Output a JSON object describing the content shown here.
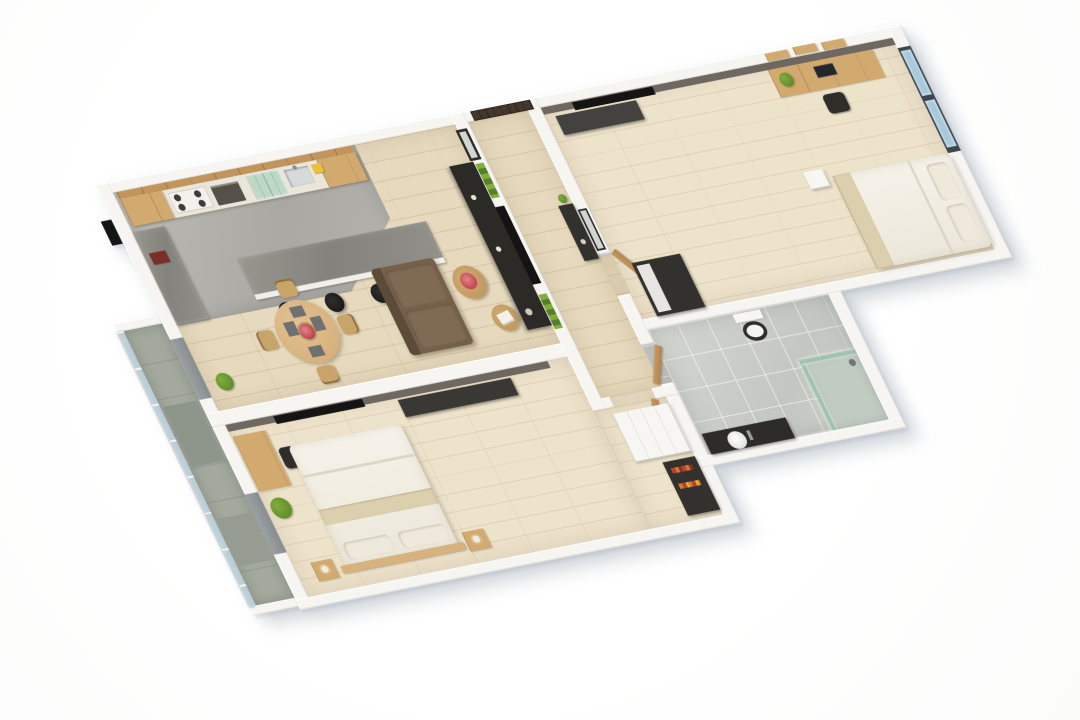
{
  "scene": {
    "type": "3d-floor-plan-render",
    "view": "isometric-birds-eye",
    "rotation_deg": -22,
    "background": "#ffffff",
    "visible_text": ""
  },
  "palette": {
    "wall": "#f6f5f2",
    "wall_edge": "#e2e0da",
    "wood_floor": "#e6d9bd",
    "wood_light": "#ede2ca",
    "concrete": "#aeada8",
    "tile": "#cdcfca",
    "balcony_floor": "#a3a99d",
    "stone_counter": "#8c8b85",
    "cabinet_wood": "#d2a96f",
    "counter_white": "#eae6dc",
    "entry_door": "#43372e",
    "door_wood": "#c79a62",
    "accent_wall": "#6f6861",
    "dark_unit": "#33312d",
    "media_dark": "#2b2a27",
    "sofa": "#75604b",
    "sofa_dark": "#5d4b39",
    "table_wood": "#d7b27e",
    "wicker": "#c09a62",
    "green": "#7fae3a",
    "green_dark": "#567f2a",
    "flower_red": "#c2464e",
    "glass_blue": "#a7c9db",
    "window_frame": "#3d474f",
    "glass_green": "#bcd9c8",
    "white_fixture": "#f7f6f2",
    "black": "#141414",
    "bed_white": "#f5f2ea",
    "pillow": "#efe9dc",
    "throw": "#dccfae",
    "gray_panel": "#8f9598"
  },
  "rooms": [
    {
      "id": "kitchen",
      "floor": "concrete-and-wood",
      "items": [
        "upper-cabinets-glass",
        "base-cabinet-run",
        "gas-stove",
        "oven",
        "sink",
        "stone-side-counter",
        "island-bar",
        "bar-stools",
        "food-props"
      ],
      "bar_stool_count": 4
    },
    {
      "id": "living-dining",
      "floor": "wood-planks",
      "items": [
        "sofa",
        "coffee-table-flowers",
        "coffee-table-books",
        "round-dining-table",
        "dining-chairs",
        "place-settings",
        "flower-centerpiece",
        "media-console",
        "wall-tv",
        "vertical-garden-panels",
        "leaning-mirror",
        "floor-plant",
        "balcony-door"
      ],
      "dining_chair_count": 4,
      "vertical_garden_panel_count": 2
    },
    {
      "id": "entry-hall-corridor",
      "floor": "wood-planks",
      "items": [
        "entry-double-door",
        "console-table",
        "wall-mirror",
        "door-to-bedroom-2",
        "door-to-bathroom",
        "door-to-master-bedroom"
      ]
    },
    {
      "id": "bedroom-master",
      "floor": "wood-planks-light",
      "items": [
        "accent-wall",
        "wall-tv",
        "media-dresser",
        "desk",
        "desk-chair",
        "floor-plant",
        "double-bed",
        "pillows",
        "nightstands",
        "headboard",
        "white-wardrobe",
        "dark-shelf-unit",
        "balcony-window"
      ],
      "nightstand_count": 2,
      "pillow_count": 2
    },
    {
      "id": "bedroom-2",
      "floor": "wood-planks-light",
      "items": [
        "accent-wall",
        "wall-tv",
        "bench",
        "desk",
        "desk-chair",
        "laptop",
        "desk-plant",
        "wall-shelves",
        "picture-window",
        "double-bed",
        "pillows",
        "dark-wardrobe"
      ],
      "wall_shelf_count": 3,
      "pillow_count": 2
    },
    {
      "id": "bathroom",
      "floor": "gray-tile",
      "items": [
        "wall-hung-toilet",
        "glass-shower-enclosure",
        "vanity-counter",
        "vessel-basin",
        "faucet",
        "wood-door"
      ]
    },
    {
      "id": "balcony",
      "floor": "concrete-pavers",
      "items": [
        "glass-railing",
        "parapet-end-walls",
        "floor-mats"
      ]
    }
  ],
  "exterior": {
    "items": [
      "utility-box"
    ],
    "shadow_color": "#8fa0ae"
  }
}
